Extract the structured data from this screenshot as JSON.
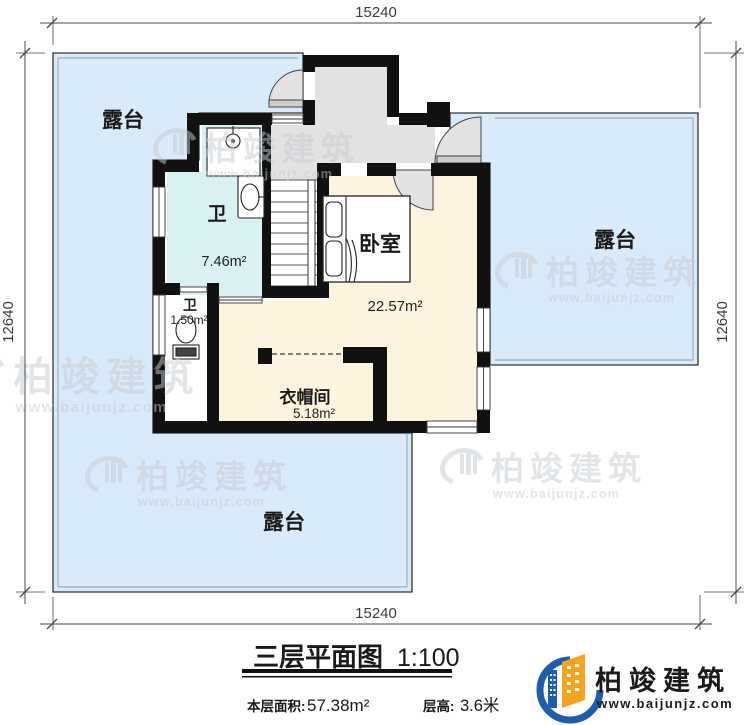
{
  "plan": {
    "dimensions": {
      "top": "15240",
      "bottom": "15240",
      "left": "12640",
      "right": "12640"
    },
    "rooms": {
      "terrace_top_left": {
        "label": "露台"
      },
      "terrace_right": {
        "label": "露台"
      },
      "terrace_bottom": {
        "label": "露台"
      },
      "bathroom": {
        "label": "卫",
        "area": "7.46m²"
      },
      "wc": {
        "label": "卫",
        "area": "1.50m²"
      },
      "bedroom": {
        "label": "卧室",
        "area": "22.57m²"
      },
      "cloakroom": {
        "label": "衣帽间",
        "area": "5.18m²"
      }
    }
  },
  "watermark": {
    "brand": "柏竣建筑",
    "url": "www.baijunjz.com"
  },
  "title_block": {
    "title": "三层平面图",
    "scale": "1:100",
    "floor_area_label": "本层面积:",
    "floor_area_value": "57.38m²",
    "floor_height_label": "层高:",
    "floor_height_value": "3.6米"
  },
  "logo": {
    "brand": "柏竣建筑",
    "url": "www.baijunjz.com"
  },
  "colors": {
    "terrace": "#d9eafa",
    "bathroom": "#d9f1f2",
    "room_cream": "#fcf4df",
    "landing_gray": "#e2e2e2",
    "wall": "#111111",
    "logo_blue": "#1d5dad",
    "logo_orange": "#f6a41f"
  }
}
